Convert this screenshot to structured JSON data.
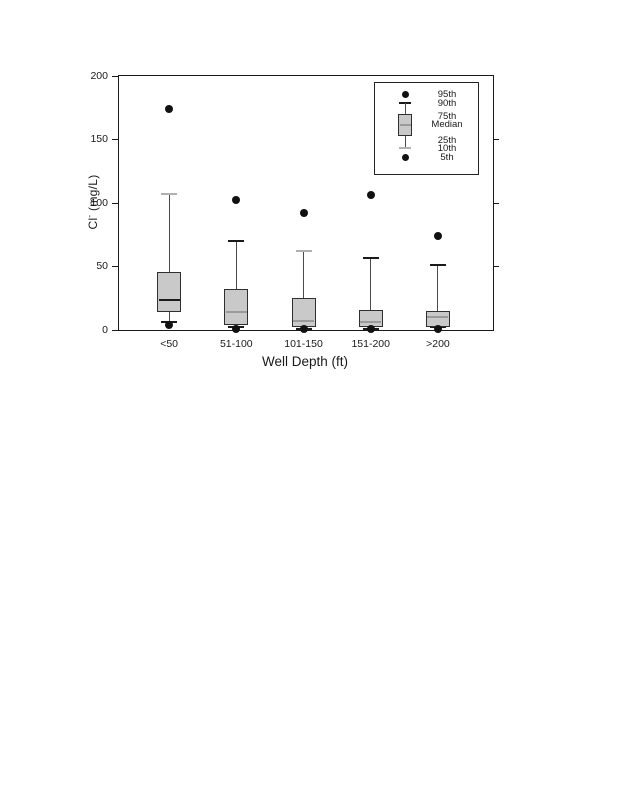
{
  "page": {
    "background": "#ffffff"
  },
  "chart_data": {
    "type": "boxplot",
    "title": "",
    "xlabel": "Well Depth (ft)",
    "ylabel": "Cl- (mg/L)",
    "ylabel_parts": {
      "element": "Cl",
      "superscript": "-",
      "unit": " (mg/L)"
    },
    "ylim": [
      0,
      200
    ],
    "yticks": [
      0,
      50,
      100,
      150,
      200
    ],
    "right_tick_values": [
      50,
      100,
      150
    ],
    "grid": false,
    "categories": [
      "<50",
      "51-100",
      "101-150",
      "151-200",
      ">200"
    ],
    "series": [
      {
        "category": "<50",
        "p5": 4,
        "p10": 6,
        "p25": 14,
        "median": 24,
        "p75": 46,
        "p90": 107,
        "p95": 174,
        "median_shade": "dark",
        "top_cap_shade": "light"
      },
      {
        "category": "51-100",
        "p5": 1,
        "p10": 2,
        "p25": 4,
        "median": 14,
        "p75": 32,
        "p90": 70,
        "p95": 102,
        "median_shade": "light",
        "top_cap_shade": "dark"
      },
      {
        "category": "101-150",
        "p5": 1,
        "p10": 1,
        "p25": 2,
        "median": 7,
        "p75": 25,
        "p90": 62,
        "p95": 92,
        "median_shade": "light",
        "top_cap_shade": "light"
      },
      {
        "category": "151-200",
        "p5": 1,
        "p10": 1,
        "p25": 2,
        "median": 6,
        "p75": 16,
        "p90": 57,
        "p95": 106,
        "median_shade": "light",
        "top_cap_shade": "dark"
      },
      {
        "category": ">200",
        "p5": 1,
        "p10": 2,
        "p25": 2,
        "median": 10,
        "p75": 15,
        "p90": 51,
        "p95": 74,
        "median_shade": "light",
        "top_cap_shade": "dark"
      }
    ],
    "legend": {
      "position": "top-right",
      "entries": [
        "95th",
        "90th",
        "75th",
        "Median",
        "25th",
        "10th",
        "5th"
      ]
    },
    "colors": {
      "frame": "#1a1a1a",
      "box_fill": "#c9c9c9",
      "box_border": "#2f2f2f",
      "whisker": "#4a4a4a",
      "cap_dark": "#1a1a1a",
      "cap_light": "#b0b0b0",
      "median_dark": "#1a1a1a",
      "median_light": "#9a9a9a",
      "dot": "#111111"
    }
  }
}
